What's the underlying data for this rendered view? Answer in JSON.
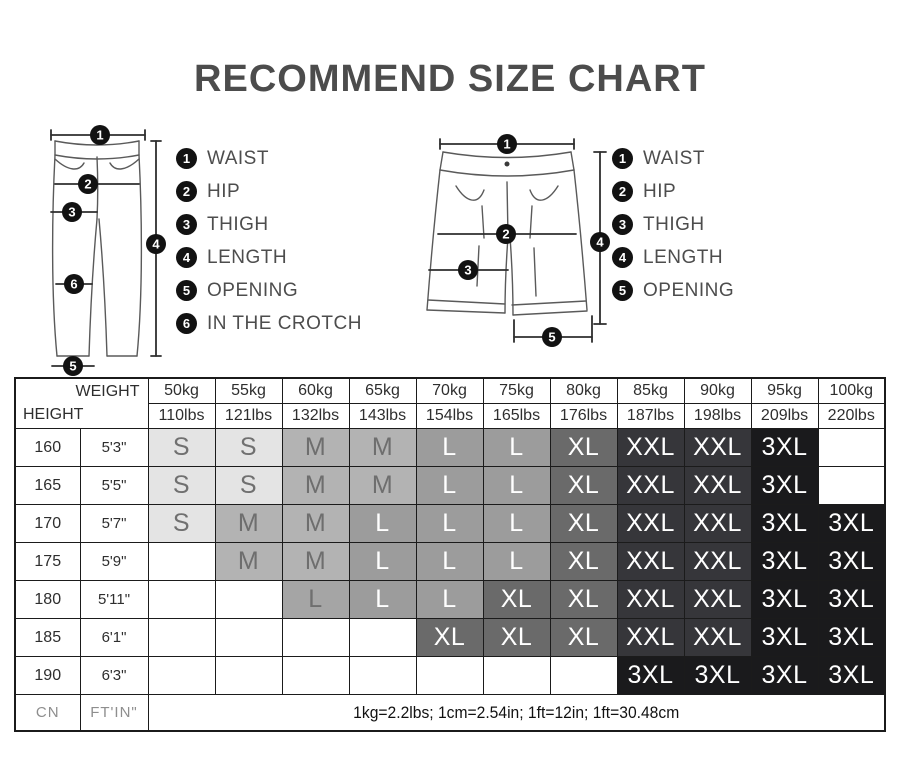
{
  "title": "RECOMMEND SIZE CHART",
  "diagrams": {
    "pants": {
      "legend": [
        {
          "num": "1",
          "label": "WAIST"
        },
        {
          "num": "2",
          "label": "HIP"
        },
        {
          "num": "3",
          "label": "THIGH"
        },
        {
          "num": "4",
          "label": "LENGTH"
        },
        {
          "num": "5",
          "label": "OPENING"
        },
        {
          "num": "6",
          "label": "IN THE CROTCH"
        }
      ]
    },
    "shorts": {
      "legend": [
        {
          "num": "1",
          "label": "WAIST"
        },
        {
          "num": "2",
          "label": "HIP"
        },
        {
          "num": "3",
          "label": "THIGH"
        },
        {
          "num": "4",
          "label": "LENGTH"
        },
        {
          "num": "5",
          "label": "OPENING"
        }
      ]
    }
  },
  "table": {
    "corner": {
      "weight": "WEIGHT",
      "height": "HEIGHT"
    },
    "weight_columns": [
      {
        "kg": "50kg",
        "lbs": "110lbs"
      },
      {
        "kg": "55kg",
        "lbs": "121lbs"
      },
      {
        "kg": "60kg",
        "lbs": "132lbs"
      },
      {
        "kg": "65kg",
        "lbs": "143lbs"
      },
      {
        "kg": "70kg",
        "lbs": "154lbs"
      },
      {
        "kg": "75kg",
        "lbs": "165lbs"
      },
      {
        "kg": "80kg",
        "lbs": "176lbs"
      },
      {
        "kg": "85kg",
        "lbs": "187lbs"
      },
      {
        "kg": "90kg",
        "lbs": "198lbs"
      },
      {
        "kg": "95kg",
        "lbs": "209lbs"
      },
      {
        "kg": "100kg",
        "lbs": "220lbs"
      }
    ],
    "rows": [
      {
        "cm": "160",
        "ftin": "5'3\"",
        "cells": [
          "S",
          "S",
          "M",
          "M",
          "L",
          "L",
          "XL",
          "XXL",
          "XXL",
          "3XL",
          ""
        ]
      },
      {
        "cm": "165",
        "ftin": "5'5\"",
        "cells": [
          "S",
          "S",
          "M",
          "M",
          "L",
          "L",
          "XL",
          "XXL",
          "XXL",
          "3XL",
          ""
        ]
      },
      {
        "cm": "170",
        "ftin": "5'7\"",
        "cells": [
          "S",
          "M",
          "M",
          "L",
          "L",
          "L",
          "XL",
          "XXL",
          "XXL",
          "3XL",
          "3XL"
        ]
      },
      {
        "cm": "175",
        "ftin": "5'9\"",
        "cells": [
          "",
          "M",
          "M",
          "L",
          "L",
          "L",
          "XL",
          "XXL",
          "XXL",
          "3XL",
          "3XL"
        ]
      },
      {
        "cm": "180",
        "ftin": "5'11\"",
        "cells": [
          "",
          "",
          "L",
          "L",
          "L",
          "XL",
          "XL",
          "XXL",
          "XXL",
          "3XL",
          "3XL"
        ],
        "muted_cols": [
          2
        ]
      },
      {
        "cm": "185",
        "ftin": "6'1\"",
        "cells": [
          "",
          "",
          "",
          "",
          "XL",
          "XL",
          "XL",
          "XXL",
          "XXL",
          "3XL",
          "3XL"
        ]
      },
      {
        "cm": "190",
        "ftin": "6'3\"",
        "cells": [
          "",
          "",
          "",
          "",
          "",
          "",
          "",
          "3XL",
          "3XL",
          "3XL",
          "3XL"
        ]
      }
    ],
    "footer": {
      "cm_unit": "CN",
      "ftin_unit": "FT'IN\"",
      "note": "1kg=2.2lbs; 1cm=2.54in; 1ft=12in; 1ft=30.48cm"
    }
  },
  "size_colors": {
    "S": {
      "bg": "#e4e4e4",
      "fg": "#707070"
    },
    "M": {
      "bg": "#b3b3b3",
      "fg": "#6e6e6e"
    },
    "L": {
      "bg": "#9c9c9c",
      "fg": "#ffffff"
    },
    "XL": {
      "bg": "#6a6a6a",
      "fg": "#ffffff"
    },
    "XXL": {
      "bg": "#36363a",
      "fg": "#ffffff"
    },
    "3XL": {
      "bg": "#1a1a1c",
      "fg": "#ffffff"
    },
    "muted": {
      "bg": "#a5a5a5",
      "fg": "#6f6f6f"
    }
  }
}
